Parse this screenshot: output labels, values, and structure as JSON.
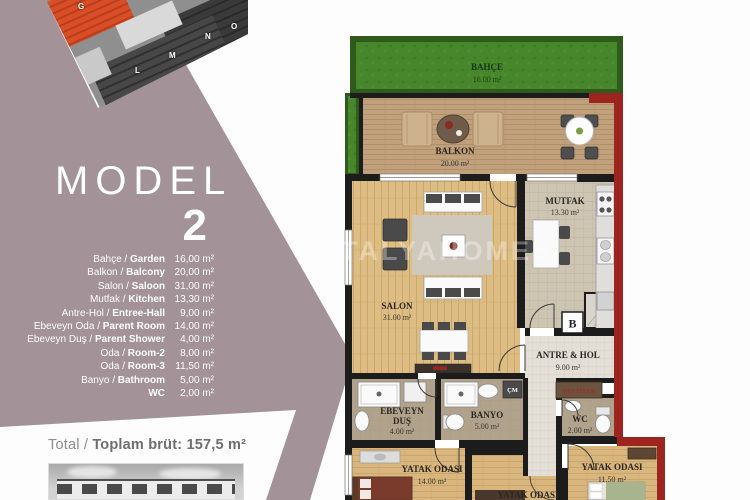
{
  "left": {
    "model_label": "MODEL",
    "model_number": "2",
    "site_letters": [
      "G",
      "L",
      "M",
      "N",
      "O"
    ],
    "rooms": [
      {
        "tr": "Bahçe / ",
        "en": "Garden",
        "area": "16,00 m²"
      },
      {
        "tr": "Balkon / ",
        "en": "Balcony",
        "area": "20,00 m²"
      },
      {
        "tr": "Salon / ",
        "en": "Saloon",
        "area": "31,00 m²"
      },
      {
        "tr": "Mutfak / ",
        "en": "Kitchen",
        "area": "13,30 m²"
      },
      {
        "tr": "Antre-Hol / ",
        "en": "Entree-Hall",
        "area": "9,00 m²"
      },
      {
        "tr": "Ebeveyn Oda / ",
        "en": "Parent Room",
        "area": "14,00 m²"
      },
      {
        "tr": "Ebeveyn Duş / ",
        "en": "Parent Shower",
        "area": "4,00 m²"
      },
      {
        "tr": "Oda / ",
        "en": "Room-2",
        "area": "8,00 m²"
      },
      {
        "tr": "Oda / ",
        "en": "Room-3",
        "area": "11,50 m²"
      },
      {
        "tr": "Banyo / ",
        "en": "Bathroom",
        "area": "5,00 m²"
      },
      {
        "tr": "",
        "en": "WC",
        "area": "2,00 m²"
      }
    ],
    "total_label": "Total / ",
    "total_value": "Toplam brüt: 157,5 m²"
  },
  "watermark": "ANTALYAHOMES",
  "plan": {
    "garden": {
      "label": "BAHÇE",
      "area": "16.00 m²"
    },
    "balcony": {
      "label": "BALKON",
      "area": "20.00 m²"
    },
    "salon": {
      "label": "SALON",
      "area": "31.00 m²"
    },
    "kitchen": {
      "label": "MUTFAK",
      "area": "13.30 m²"
    },
    "hall": {
      "label": "ANTRE & HOL",
      "area": "9.00 m²"
    },
    "parent_shower": {
      "l1": "EBEVEYN",
      "l2": "DUŞ",
      "area": "4.00 m²"
    },
    "bath": {
      "label": "BANYO",
      "area": "5.00 m²"
    },
    "wc": {
      "label": "WC",
      "area": "2.00 m²"
    },
    "bed1": {
      "label": "YATAK ODASI",
      "area": "14.00 m²"
    },
    "bed2": {
      "label": "YATAK ODASI"
    },
    "bed3": {
      "label": "YATAK ODASI",
      "area": "11.50 m²"
    },
    "vestiyer_label": "VESTİYER",
    "washer_label": "ÇM",
    "entrance_label": "B"
  },
  "colors": {
    "mauve": "#a39298",
    "accent_red_wall": "#9e2420",
    "grass_green": "#47862a",
    "wall_black": "#1c1c1c",
    "highlight_building_orange": "#d94e27"
  }
}
